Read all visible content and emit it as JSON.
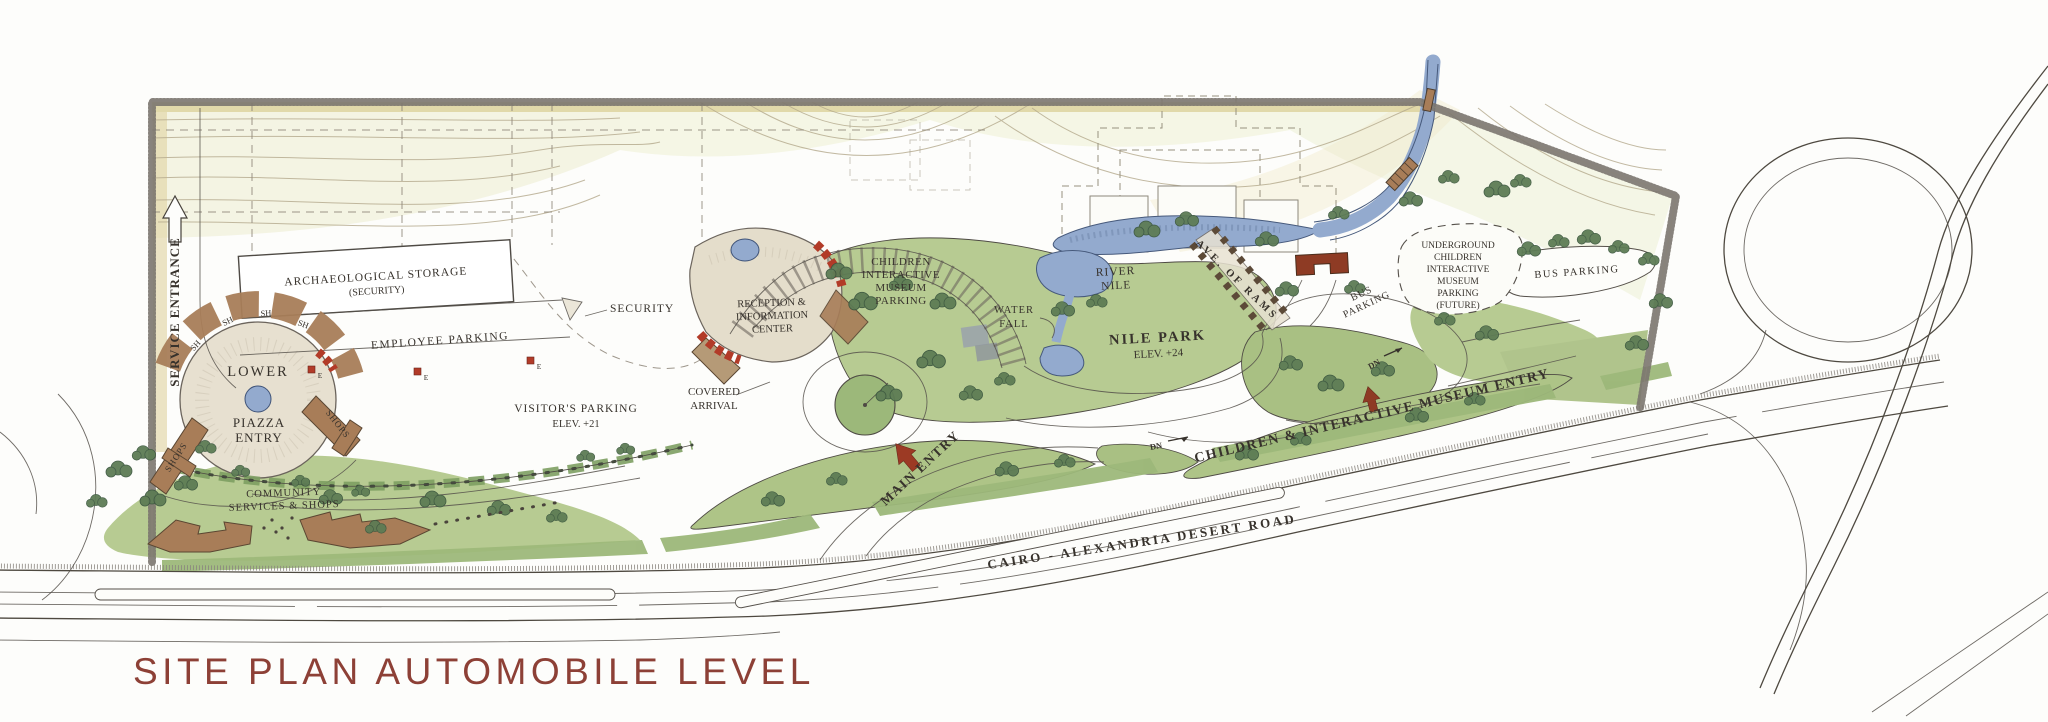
{
  "title": "SITE PLAN AUTOMOBILE LEVEL",
  "colors": {
    "title": "#8d4036",
    "paper": "#fdfdfb",
    "park_green": "#b7cb92",
    "berm_green": "#aec487",
    "verge_green": "#9db87a",
    "water_blue": "#93aace",
    "building_brown": "#a87d58",
    "roof_red": "#b23b28",
    "arrow_red": "#9c3a24",
    "ink": "#37322c"
  },
  "labels": {
    "service_entrance": "SERVICE ENTRANCE",
    "archaeological_storage": [
      "ARCHAEOLOGICAL STORAGE",
      "(SECURITY)"
    ],
    "employee_parking": "EMPLOYEE PARKING",
    "security": "SECURITY",
    "visitors_parking": [
      "VISITOR'S PARKING",
      "ELEV. +21"
    ],
    "lower_piazza": [
      "LOWER",
      "PIAZZA",
      "ENTRY"
    ],
    "shops_left": "SHOPS",
    "shops_right": "SHOPS",
    "sh": "SH",
    "entrance_marker": "E",
    "community": [
      "COMMUNITY",
      "SERVICES & SHOPS"
    ],
    "reception": [
      "RECEPTION &",
      "INFORMATION",
      "CENTER"
    ],
    "covered_arrival": [
      "COVERED",
      "ARRIVAL"
    ],
    "children_parking": [
      "CHILDREN",
      "INTERACTIVE",
      "MUSEUM",
      "PARKING"
    ],
    "water_fall": [
      "WATER",
      "FALL"
    ],
    "river_nile": [
      "RIVER",
      "NILE"
    ],
    "nile_park": [
      "NILE PARK",
      "ELEV. +24"
    ],
    "ave_of_rams": "AVE. OF RAMS",
    "bus_parking_loop": [
      "BUS",
      "PARKING"
    ],
    "underground_parking": [
      "UNDERGROUND",
      "CHILDREN",
      "INTERACTIVE",
      "MUSEUM",
      "PARKING",
      "(FUTURE)"
    ],
    "bus_parking_east": "BUS PARKING",
    "main_entry": "MAIN ENTRY",
    "children_museum_entry": "CHILDREN & INTERACTIVE MUSEUM ENTRY",
    "desert_road": "CAIRO - ALEXANDRIA DESERT ROAD",
    "down_ramp": "DN"
  }
}
